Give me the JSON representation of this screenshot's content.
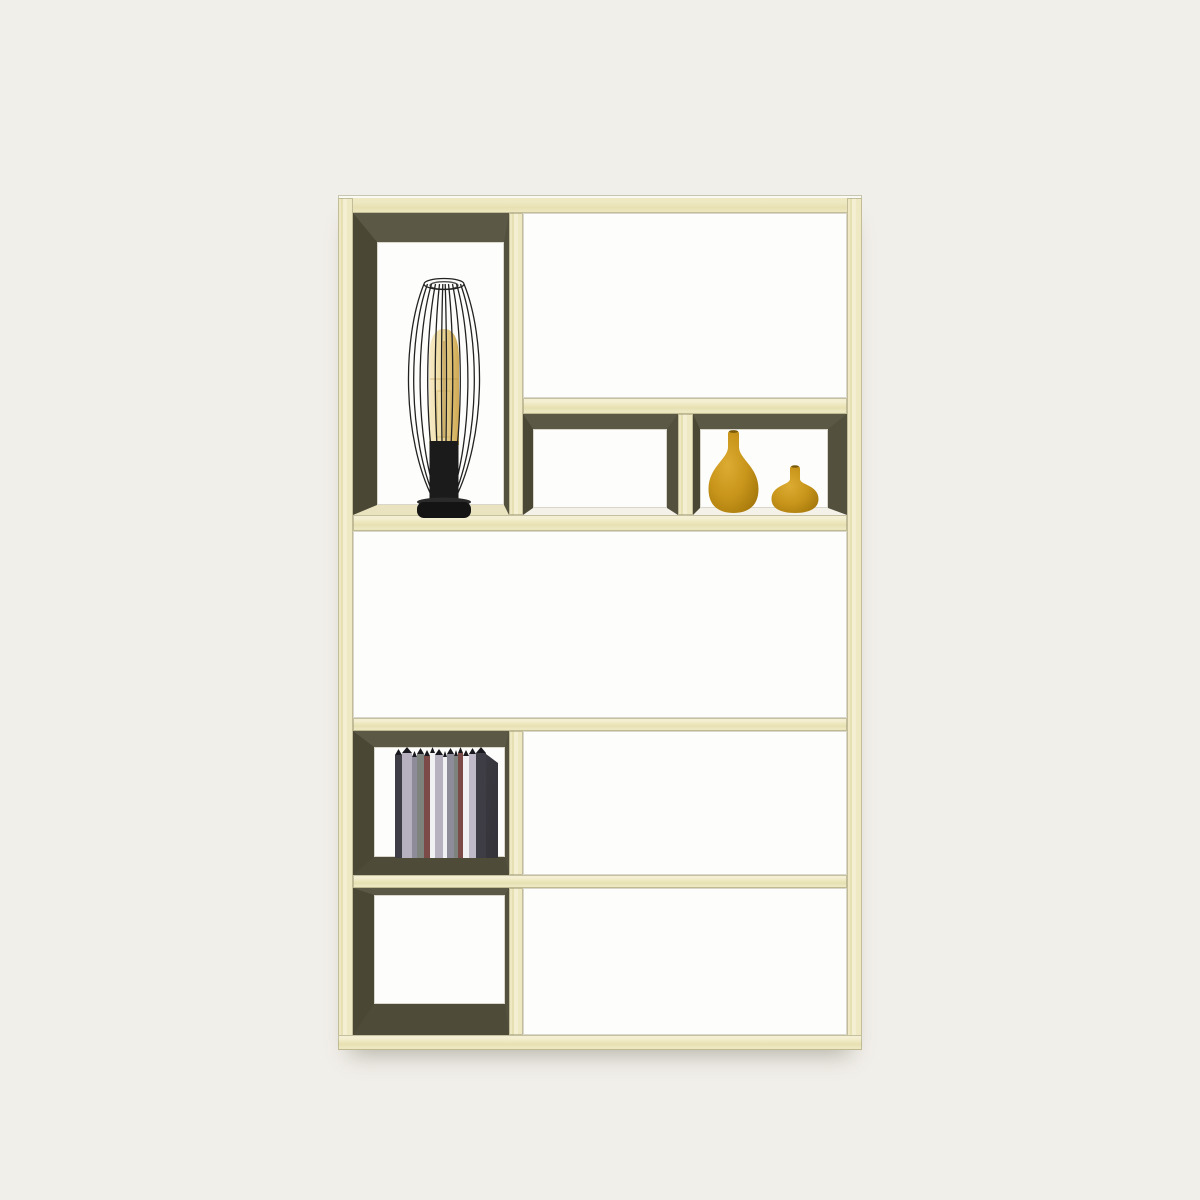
{
  "palette": {
    "bg": "#f1efe9",
    "wood_base": "#efe9c3",
    "wood_light": "#f4efd2",
    "wood_dark": "#e7e0b2",
    "frame_highlight": "#fafaf4",
    "ceil": "#5b5846",
    "wall_left": "#4a4735",
    "wall_right": "#53503e",
    "floor_dark": "#4e4b39",
    "floor_pale": "#e9e4bf",
    "comp_white": "#fdfdfb",
    "comp_outline": "#d9d7cb",
    "lamp_black": "#1c1c1c",
    "bulb_amber": "#ecd9a4",
    "vase_main": "#c9961b",
    "vase_light": "#dcab31",
    "vase_dark": "#9a700c",
    "book_top_edge": "#1a191f"
  },
  "shelf_unit": {
    "material": "pale-wood",
    "rows": 4,
    "compartments": [
      {
        "id": "top-left",
        "interior": "dark-olive",
        "content": "wire-cage-table-lamp"
      },
      {
        "id": "top-right-upper",
        "interior": "white",
        "content": "empty"
      },
      {
        "id": "top-right-lower-left",
        "interior": "dark-olive",
        "content": "empty"
      },
      {
        "id": "top-right-lower-right",
        "interior": "dark-olive",
        "content": "two-yellow-vases"
      },
      {
        "id": "middle-full-width",
        "interior": "white",
        "content": "empty"
      },
      {
        "id": "row3-left",
        "interior": "dark-olive",
        "content": "row-of-books"
      },
      {
        "id": "row3-right",
        "interior": "white",
        "content": "empty"
      },
      {
        "id": "bottom-left",
        "interior": "dark-olive",
        "content": "empty"
      },
      {
        "id": "bottom-right",
        "interior": "white",
        "content": "empty"
      }
    ]
  },
  "lamp": {
    "type": "wire-cage-table-lamp",
    "cage_color": "#1c1c1c",
    "bulb_color": "#ecd9a4",
    "base_color": "#141414"
  },
  "vases": {
    "count": 2,
    "large": {
      "shape": "teardrop-long-neck",
      "color": "#c9961b"
    },
    "small": {
      "shape": "round-squat",
      "color": "#c9961b"
    }
  },
  "books": {
    "count": 15,
    "top_edge": "#1a191f",
    "items": [
      {
        "w": 7,
        "h": 109,
        "c": "#3e3c44"
      },
      {
        "w": 10,
        "h": 111,
        "c": "#b7b1bf"
      },
      {
        "w": 5,
        "h": 107,
        "c": "#8e8c98"
      },
      {
        "w": 7,
        "h": 110,
        "c": "#7f837d"
      },
      {
        "w": 6,
        "h": 108,
        "c": "#7c4a47"
      },
      {
        "w": 5,
        "h": 111,
        "c": "#f1f0f3"
      },
      {
        "w": 8,
        "h": 109,
        "c": "#b7b1bf"
      },
      {
        "w": 4,
        "h": 107,
        "c": "#f1f0f3"
      },
      {
        "w": 7,
        "h": 110,
        "c": "#8e8c98"
      },
      {
        "w": 4,
        "h": 108,
        "c": "#7f837d"
      },
      {
        "w": 5,
        "h": 111,
        "c": "#7c4a47"
      },
      {
        "w": 6,
        "h": 108,
        "c": "#f1f0f3"
      },
      {
        "w": 7,
        "h": 110,
        "c": "#c0bac8"
      },
      {
        "w": 10,
        "h": 111,
        "c": "#3e3c44"
      },
      {
        "w": 12,
        "h": 106,
        "c": "#34333a",
        "side": true
      }
    ]
  }
}
